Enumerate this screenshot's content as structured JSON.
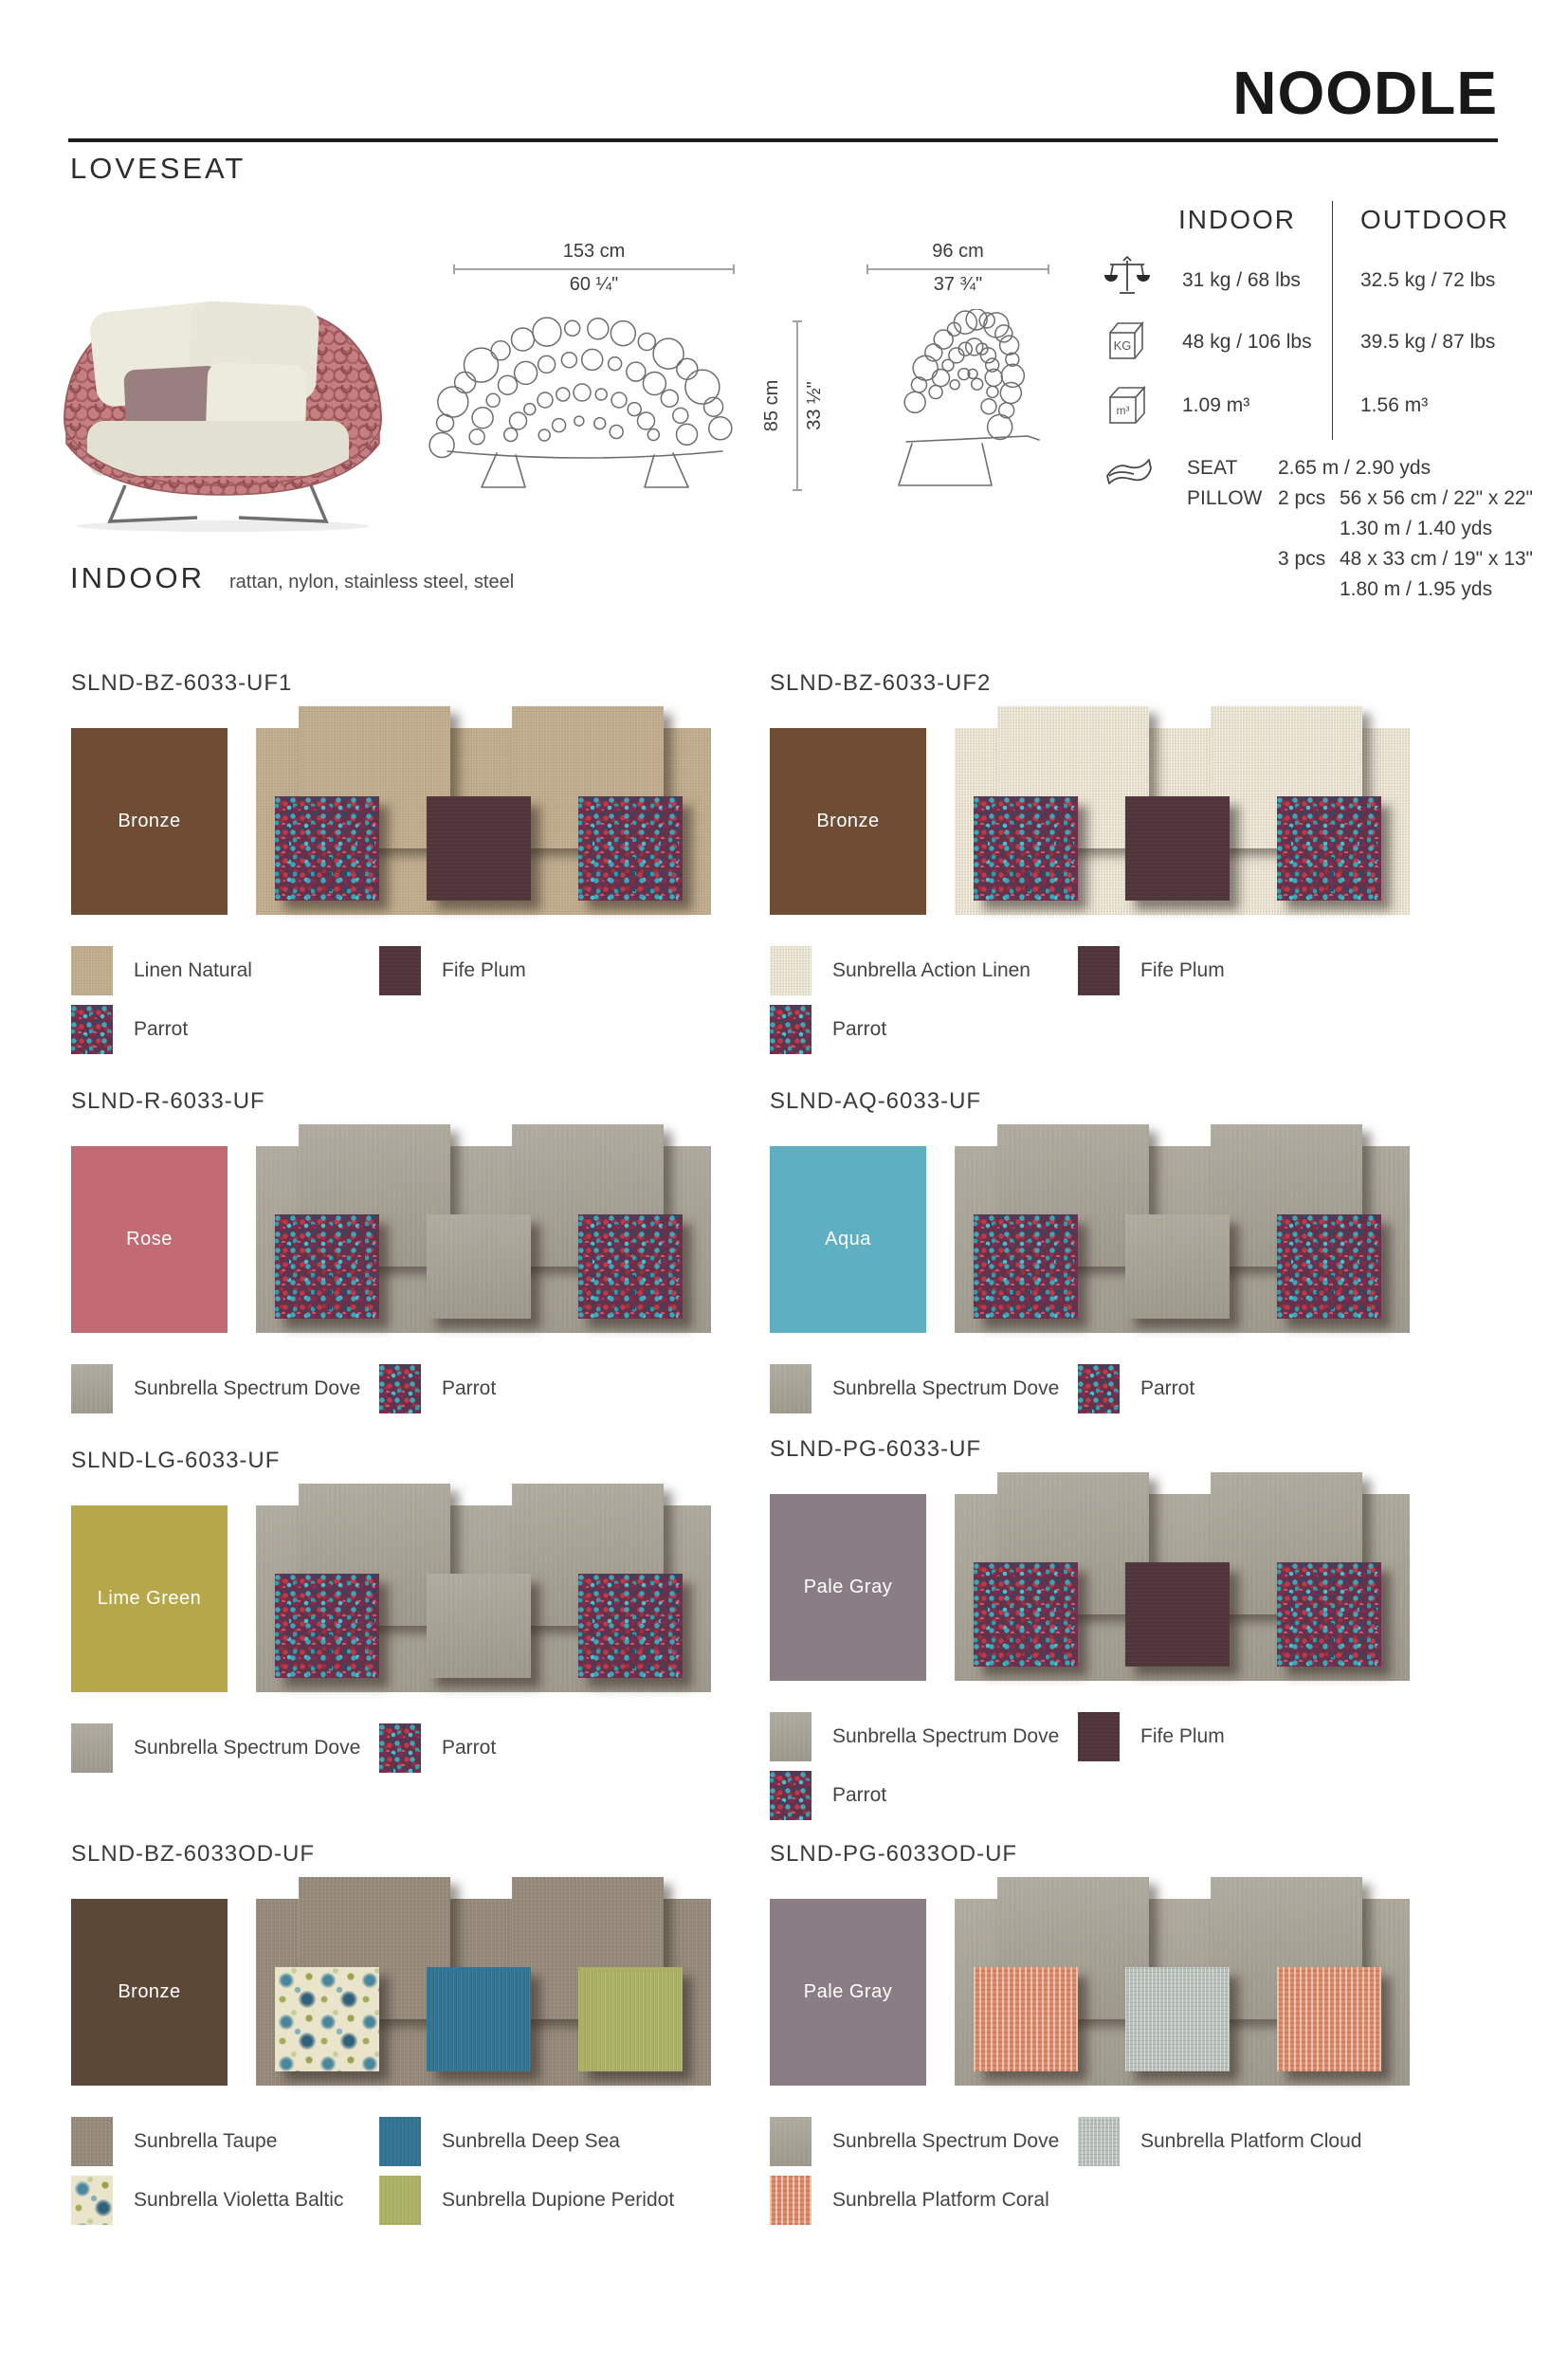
{
  "header": {
    "brand": "NOODLE",
    "product": "LOVESEAT"
  },
  "drawings": {
    "front": {
      "metric": "153 cm",
      "imperial": "60 ¼\""
    },
    "side": {
      "metric": "96 cm",
      "imperial": "37 ¾\""
    },
    "height": {
      "metric": "85 cm",
      "imperial": "33 ½\""
    }
  },
  "spec_table": {
    "indoor_header": "INDOOR",
    "outdoor_header": "OUTDOOR",
    "rows": [
      {
        "icon": "scale-icon",
        "indoor": "31 kg / 68 lbs",
        "outdoor": "32.5 kg / 72 lbs"
      },
      {
        "icon": "kg-box-icon",
        "indoor": "48 kg / 106 lbs",
        "outdoor": "39.5 kg / 87 lbs"
      },
      {
        "icon": "m3-box-icon",
        "indoor": "1.09 m³",
        "outdoor": "1.56 m³"
      }
    ],
    "fabric_usage": {
      "icon": "fabric-roll-icon",
      "seat_label": "SEAT",
      "pillow_label": "PILLOW",
      "lines": [
        {
          "pcs": "",
          "text": "2.65 m / 2.90 yds"
        },
        {
          "pcs": "2 pcs",
          "text": "56 x 56 cm / 22\" x 22\""
        },
        {
          "pcs": "",
          "text": "1.30 m / 1.40 yds"
        },
        {
          "pcs": "3 pcs",
          "text": "48 x 33 cm / 19\" x 13\""
        },
        {
          "pcs": "",
          "text": "1.80 m / 1.95 yds"
        }
      ]
    }
  },
  "materials": {
    "category": "INDOOR",
    "list": "rattan, nylon, stainless steel, steel"
  },
  "fabrics": {
    "linen": {
      "label": "Linen Natural",
      "hex": "#BFAB8C"
    },
    "action-linen": {
      "label": "Sunbrella Action Linen",
      "hex": "#E5DFCC"
    },
    "plum": {
      "label": "Fife Plum",
      "hex": "#4F3439"
    },
    "parrot": {
      "label": "Parrot",
      "hex": "#64324A"
    },
    "dove": {
      "label": "Sunbrella Spectrum Dove",
      "hex": "#A6A093"
    },
    "taupe": {
      "label": "Sunbrella Taupe",
      "hex": "#95897A"
    },
    "deep-sea": {
      "label": "Sunbrella Deep Sea",
      "hex": "#2F7291"
    },
    "violetta": {
      "label": "Sunbrella Violetta Baltic",
      "hex": "#EAE4CB"
    },
    "peridot": {
      "label": "Sunbrella Dupione Peridot",
      "hex": "#A8AE5E"
    },
    "cloud": {
      "label": "Sunbrella Platform Cloud",
      "hex": "#B9C0BB"
    },
    "coral": {
      "label": "Sunbrella Platform Coral",
      "hex": "#D88E70"
    }
  },
  "variants": [
    {
      "sku": "SLND-BZ-6033-UF1",
      "frame_label": "Bronze",
      "frame_hex": "#6F4C34",
      "bg": "linen",
      "tabs": "linen",
      "left": "parrot",
      "center": "plum",
      "right": "parrot",
      "legend": [
        "linen",
        "plum",
        "parrot"
      ]
    },
    {
      "sku": "SLND-BZ-6033-UF2",
      "frame_label": "Bronze",
      "frame_hex": "#6F4C34",
      "bg": "action-linen",
      "tabs": "action-linen",
      "left": "parrot",
      "center": "plum",
      "right": "parrot",
      "legend": [
        "action-linen",
        "plum",
        "parrot"
      ]
    },
    {
      "sku": "SLND-R-6033-UF",
      "frame_label": "Rose",
      "frame_hex": "#C26B75",
      "bg": "dove",
      "tabs": "dove",
      "left": "parrot",
      "center": "dove",
      "right": "parrot",
      "legend": [
        "dove",
        "parrot"
      ]
    },
    {
      "sku": "SLND-AQ-6033-UF",
      "frame_label": "Aqua",
      "frame_hex": "#5FAFC2",
      "bg": "dove",
      "tabs": "dove",
      "left": "parrot",
      "center": "dove",
      "right": "parrot",
      "legend": [
        "dove",
        "parrot"
      ]
    },
    {
      "sku": "SLND-LG-6033-UF",
      "frame_label": "Lime Green",
      "frame_hex": "#B6A74B",
      "bg": "dove",
      "tabs": "dove",
      "left": "parrot",
      "center": "dove",
      "right": "parrot",
      "legend": [
        "dove",
        "parrot"
      ]
    },
    {
      "sku": "SLND-PG-6033-UF",
      "frame_label": "Pale Gray",
      "frame_hex": "#8A7D84",
      "bg": "dove",
      "tabs": "dove",
      "left": "parrot",
      "center": "plum",
      "right": "parrot",
      "legend": [
        "dove",
        "plum",
        "parrot"
      ]
    },
    {
      "sku": "SLND-BZ-6033OD-UF",
      "frame_label": "Bronze",
      "frame_hex": "#5C4836",
      "bg": "taupe",
      "tabs": "taupe",
      "left": "violetta",
      "center": "deep-sea",
      "right": "peridot",
      "legend": [
        "taupe",
        "deep-sea",
        "violetta",
        "peridot"
      ]
    },
    {
      "sku": "SLND-PG-6033OD-UF",
      "frame_label": "Pale Gray",
      "frame_hex": "#8A7D84",
      "bg": "dove",
      "tabs": "dove",
      "left": "coral",
      "center": "cloud",
      "right": "coral",
      "legend": [
        "dove",
        "cloud",
        "coral"
      ]
    }
  ]
}
